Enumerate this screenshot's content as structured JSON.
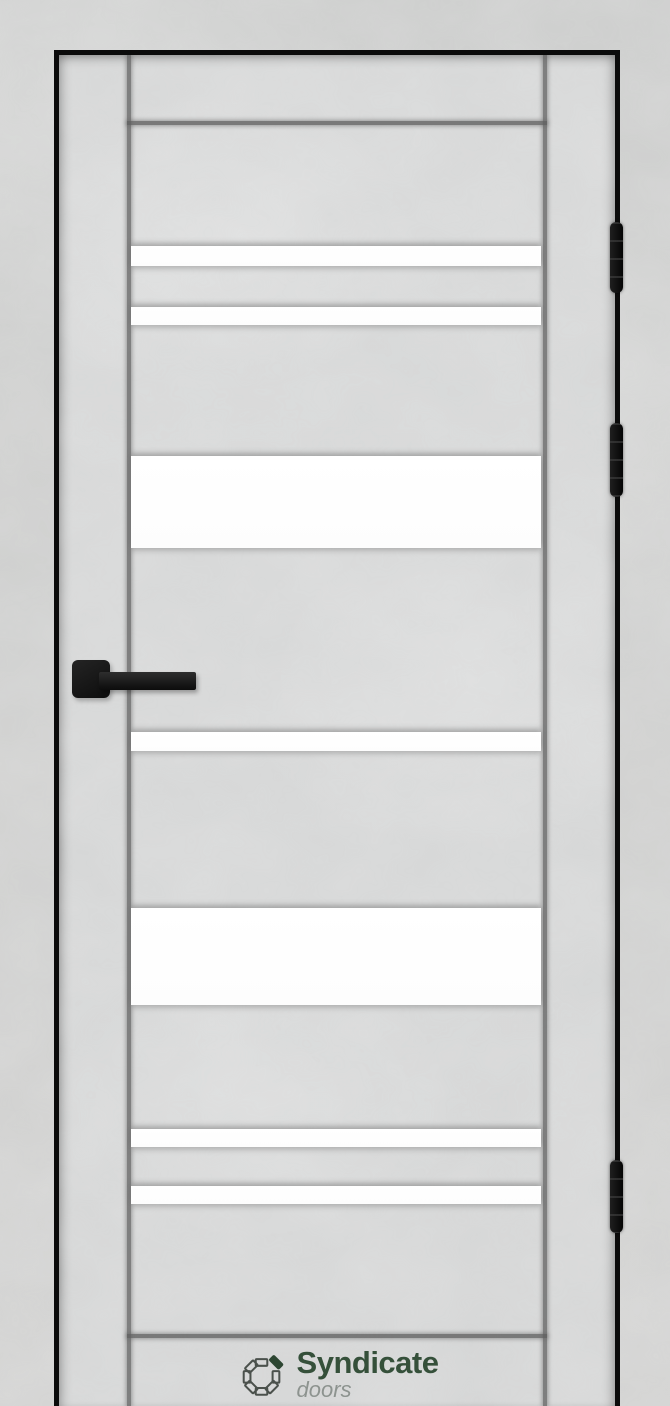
{
  "logo": {
    "name": "Syndicate",
    "subtitle": "doors",
    "icon": "pinwheel-petals-logo"
  },
  "door": {
    "glass_stripe_count": 7,
    "hinge_count": 3,
    "handle_side": "left",
    "hinge_side": "right",
    "finish": "light concrete texture",
    "edge_trim": "black"
  },
  "colors": {
    "brand_green": "#35503a",
    "subtitle_gray": "#8d938f",
    "edge_black": "#0b0b0b",
    "hardware_black": "#141414",
    "wall_gray": "#cfcfcf",
    "door_gray": "#d7d8d8",
    "glass_white": "#ffffff"
  }
}
